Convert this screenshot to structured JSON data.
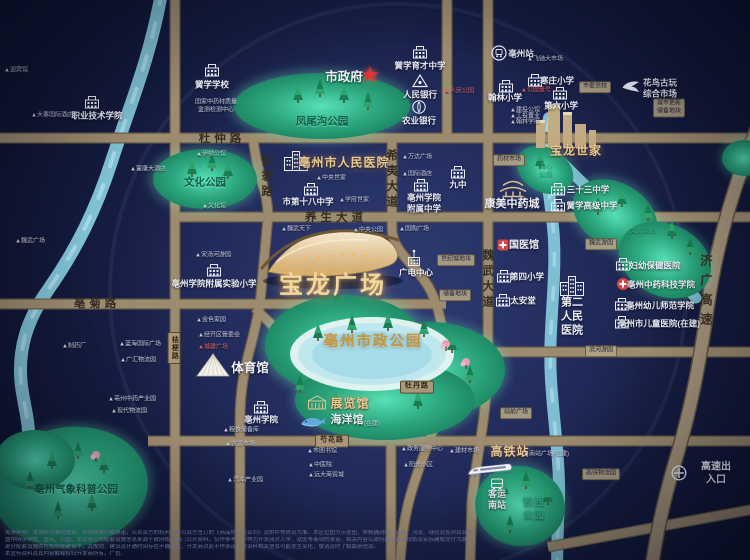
{
  "map": {
    "colors": {
      "background": "#141b3e",
      "road": "#9d8b6f",
      "highway": "#a5947a",
      "river": "#8fd8e9",
      "park": "#2fa980",
      "gold_accent": "#e9c894",
      "red_accent": "#e03434",
      "white_label": "#e9ebf5"
    },
    "labels": [
      {
        "t": "▲迎宾馆",
        "x": 16,
        "y": 71,
        "c": "tiny"
      },
      {
        "t": "▲大寨国际酒店",
        "x": 52,
        "y": 116,
        "c": "tiny"
      },
      {
        "t": "职业技术学院",
        "x": 97,
        "y": 116,
        "c": "w",
        "i": "building",
        "ix": 92,
        "iy": 102,
        "n": "vocational-college"
      },
      {
        "t": "黉学学校",
        "x": 212,
        "y": 85,
        "c": "w",
        "i": "building",
        "ix": 212,
        "iy": 70,
        "n": "hongxue-school"
      },
      {
        "t": "国家中药材质量\n监测检测中心",
        "x": 216,
        "y": 107,
        "c": "tiny"
      },
      {
        "t": "▲富康大酒店",
        "x": 148,
        "y": 170,
        "c": "tiny"
      },
      {
        "t": "凤尾沟公园",
        "x": 322,
        "y": 122,
        "c": "green",
        "n": "fengweigou-park-label"
      },
      {
        "t": "市政府",
        "x": 344,
        "y": 78,
        "c": "wb12",
        "i": "star",
        "ix": 370,
        "iy": 75,
        "n": "city-government"
      },
      {
        "t": "黉学育才中学",
        "x": 420,
        "y": 66,
        "c": "w",
        "i": "building",
        "ix": 420,
        "iy": 52
      },
      {
        "t": "人民银行",
        "x": 420,
        "y": 95,
        "c": "w",
        "i": "bank1",
        "ix": 420,
        "iy": 81
      },
      {
        "t": "农业银行",
        "x": 419,
        "y": 121,
        "c": "w",
        "i": "bank2",
        "ix": 419,
        "iy": 107
      },
      {
        "t": "▲人民公园",
        "x": 459,
        "y": 92,
        "c": "red"
      },
      {
        "t": "亳州站",
        "x": 521,
        "y": 54,
        "c": "w",
        "i": "station",
        "ix": 499,
        "iy": 53,
        "n": "bozhou-railway-station"
      },
      {
        "t": "▲飞驰大市场",
        "x": 545,
        "y": 60,
        "c": "tiny"
      },
      {
        "t": "寒庄小学",
        "x": 557,
        "y": 81,
        "c": "w",
        "i": "building",
        "ix": 535,
        "iy": 80
      },
      {
        "t": "翰林小学",
        "x": 505,
        "y": 98,
        "c": "w",
        "i": "building",
        "ix": 506,
        "iy": 86
      },
      {
        "t": "▲公园壹号",
        "x": 536,
        "y": 91,
        "c": "red"
      },
      {
        "t": "第六小学",
        "x": 561,
        "y": 106,
        "c": "w",
        "i": "building",
        "ix": 560,
        "iy": 93
      },
      {
        "t": "▲建投公馆",
        "x": 525,
        "y": 111,
        "c": "tiny"
      },
      {
        "t": "▲工投置业",
        "x": 525,
        "y": 117,
        "c": "tiny"
      },
      {
        "t": "▲翰林学府",
        "x": 525,
        "y": 123,
        "c": "tiny"
      },
      {
        "t": "市委党校",
        "x": 595,
        "y": 87,
        "c": "box"
      },
      {
        "t": "花鸟古玩\n综合市场",
        "x": 660,
        "y": 88,
        "c": "w",
        "i": "dove",
        "ix": 631,
        "iy": 86,
        "n": "flower-bird-market"
      },
      {
        "t": "城市更新\n储备地块",
        "x": 669,
        "y": 108,
        "c": "box"
      },
      {
        "t": "宝龙世家",
        "x": 576,
        "y": 151,
        "c": "gold",
        "n": "baolong-shijia"
      },
      {
        "t": "杜仲路",
        "x": 222,
        "y": 139,
        "c": "roadH",
        "n": "duzhong-road-label"
      },
      {
        "t": "▲伊顿公馆",
        "x": 211,
        "y": 155,
        "c": "tiny"
      },
      {
        "t": "文化公园",
        "x": 205,
        "y": 183,
        "c": "green",
        "n": "culture-park-label"
      },
      {
        "t": "▲文化馆",
        "x": 214,
        "y": 207,
        "c": "tiny"
      },
      {
        "t": "仙翁路",
        "x": 266,
        "y": 177,
        "c": "roadV",
        "n": "xianweng-road-label"
      },
      {
        "t": "亳州市人民医院",
        "x": 344,
        "y": 163,
        "c": "gold",
        "i": "hospital",
        "ix": 296,
        "iy": 161,
        "n": "people-hospital"
      },
      {
        "t": "▲中央世家",
        "x": 331,
        "y": 179,
        "c": "tiny"
      },
      {
        "t": "市第十八中学",
        "x": 308,
        "y": 202,
        "c": "w",
        "i": "building",
        "ix": 311,
        "iy": 189
      },
      {
        "t": "▲学府世家",
        "x": 354,
        "y": 201,
        "c": "tiny"
      },
      {
        "t": "养生大道",
        "x": 336,
        "y": 218,
        "c": "roadH",
        "n": "yangsheng-avenue-label"
      },
      {
        "t": "希夷大道",
        "x": 391,
        "y": 180,
        "c": "roadV",
        "n": "xiyi-avenue-label"
      },
      {
        "t": "▲万达广场",
        "x": 417,
        "y": 158,
        "c": "tiny"
      },
      {
        "t": "▲国际酒店",
        "x": 417,
        "y": 175,
        "c": "tiny"
      },
      {
        "t": "九中",
        "x": 458,
        "y": 185,
        "c": "w",
        "i": "building",
        "ix": 458,
        "iy": 172
      },
      {
        "t": "亳州学院\n附属中学",
        "x": 424,
        "y": 203,
        "c": "w",
        "i": "building",
        "ix": 421,
        "iy": 185
      },
      {
        "t": "康美中药城",
        "x": 512,
        "y": 205,
        "c": "wb11",
        "i": "pagoda",
        "ix": 513,
        "iy": 187,
        "n": "kangmei-tcm-city"
      },
      {
        "t": "三十三中学",
        "x": 588,
        "y": 190,
        "c": "w",
        "i": "building",
        "ix": 558,
        "iy": 189
      },
      {
        "t": "黉学高级中学",
        "x": 592,
        "y": 206,
        "c": "w",
        "i": "building",
        "ix": 558,
        "iy": 205
      },
      {
        "t": "药材市场",
        "x": 509,
        "y": 160,
        "c": "box"
      },
      {
        "t": "海心\n公园",
        "x": 546,
        "y": 171,
        "c": "greent"
      },
      {
        "t": "文昌公园",
        "x": 643,
        "y": 231,
        "c": "greent"
      },
      {
        "t": "▲魏武天下",
        "x": 296,
        "y": 230,
        "c": "tiny"
      },
      {
        "t": "▲中央公园",
        "x": 368,
        "y": 231,
        "c": "tiny"
      },
      {
        "t": "▲国购广场",
        "x": 414,
        "y": 230,
        "c": "tiny"
      },
      {
        "t": "宝龙广场",
        "x": 333,
        "y": 285,
        "c": "title",
        "n": "project-title"
      },
      {
        "t": "广电中心",
        "x": 416,
        "y": 273,
        "c": "w",
        "i": "tower",
        "ix": 413,
        "iy": 258
      },
      {
        "t": "世纪城地块",
        "x": 456,
        "y": 260,
        "c": "box"
      },
      {
        "t": "储备地块",
        "x": 455,
        "y": 295,
        "c": "box"
      },
      {
        "t": "魏武大道",
        "x": 487,
        "y": 280,
        "c": "roadV",
        "n": "weiwu-avenue-label"
      },
      {
        "t": "国医馆",
        "x": 524,
        "y": 246,
        "c": "wb10",
        "i": "cross",
        "ix": 503,
        "iy": 245
      },
      {
        "t": "第四小学",
        "x": 527,
        "y": 277,
        "c": "w",
        "i": "building",
        "ix": 504,
        "iy": 276
      },
      {
        "t": "太安堂",
        "x": 523,
        "y": 301,
        "c": "w",
        "i": "building",
        "ix": 503,
        "iy": 300
      },
      {
        "t": "第二\n人民\n医院",
        "x": 572,
        "y": 317,
        "c": "wb11",
        "i": "hospital",
        "ix": 572,
        "iy": 286,
        "n": "second-people-hospital"
      },
      {
        "t": "妇幼保健医院",
        "x": 655,
        "y": 266,
        "c": "w",
        "i": "building",
        "ix": 623,
        "iy": 264
      },
      {
        "t": "亳州中药科技学院",
        "x": 661,
        "y": 285,
        "c": "w",
        "i": "crossc",
        "ix": 623,
        "iy": 284
      },
      {
        "t": "亳州幼儿师范学院",
        "x": 660,
        "y": 306,
        "c": "w",
        "i": "building",
        "ix": 622,
        "iy": 304
      },
      {
        "t": "亳州市儿童医院(在建)",
        "x": 659,
        "y": 324,
        "c": "w",
        "i": "building",
        "ix": 622,
        "iy": 322
      },
      {
        "t": "济广高速",
        "x": 704,
        "y": 293,
        "c": "roadVhw",
        "n": "jiguang-expressway-label"
      },
      {
        "t": "魏武游园",
        "x": 601,
        "y": 244,
        "c": "box"
      },
      {
        "t": "滨河游园",
        "x": 601,
        "y": 351,
        "c": "box"
      },
      {
        "t": "亳菊路",
        "x": 97,
        "y": 304,
        "c": "roadH",
        "n": "boju-road-label"
      },
      {
        "t": "▲魏武广场",
        "x": 30,
        "y": 242,
        "c": "tiny"
      },
      {
        "t": "▲制药厂",
        "x": 74,
        "y": 347,
        "c": "tiny"
      },
      {
        "t": "▲蓝海国际广场",
        "x": 140,
        "y": 345,
        "c": "tiny"
      },
      {
        "t": "▲广汇物流园",
        "x": 138,
        "y": 361,
        "c": "tiny"
      },
      {
        "t": "▲亳州中药产业园",
        "x": 132,
        "y": 400,
        "c": "tiny"
      },
      {
        "t": "▲现代物流园",
        "x": 129,
        "y": 412,
        "c": "tiny"
      },
      {
        "t": "桔梗路",
        "x": 174,
        "y": 348,
        "c": "roadBoxV"
      },
      {
        "t": "▲宋汤河游园",
        "x": 213,
        "y": 256,
        "c": "tiny"
      },
      {
        "t": "亳州学院附属实验小学",
        "x": 214,
        "y": 284,
        "c": "w",
        "i": "building",
        "ix": 214,
        "iy": 270
      },
      {
        "t": "▲金色家园",
        "x": 211,
        "y": 321,
        "c": "tiny"
      },
      {
        "t": "▲经开区管委会",
        "x": 219,
        "y": 336,
        "c": "tiny"
      },
      {
        "t": "▲城建广场",
        "x": 213,
        "y": 348,
        "c": "red"
      },
      {
        "t": "体育馆",
        "x": 250,
        "y": 369,
        "c": "wb12",
        "i": "tent",
        "ix": 213,
        "iy": 365,
        "n": "stadium"
      },
      {
        "t": "亳州市政公园",
        "x": 373,
        "y": 342,
        "c": "goldlg",
        "n": "municipal-park-label"
      },
      {
        "t": "牡丹路",
        "x": 417,
        "y": 387,
        "c": "roadBox"
      },
      {
        "t": "展览馆",
        "x": 350,
        "y": 404,
        "c": "gold",
        "i": "expo",
        "ix": 317,
        "iy": 402,
        "n": "exhibition-hall"
      },
      {
        "t": "海洋馆",
        "x": 347,
        "y": 421,
        "c": "wb11",
        "i": "whale",
        "ix": 313,
        "iy": 422,
        "n": "aquarium"
      },
      {
        "t": "(在建)",
        "x": 372,
        "y": 425,
        "c": "tiny"
      },
      {
        "t": "亳州学院",
        "x": 261,
        "y": 420,
        "c": "w",
        "i": "building",
        "ix": 261,
        "iy": 407
      },
      {
        "t": "芍花路",
        "x": 332,
        "y": 441,
        "c": "roadBox"
      },
      {
        "t": "▲市图书馆",
        "x": 322,
        "y": 452,
        "c": "tiny"
      },
      {
        "t": "▲中医院",
        "x": 320,
        "y": 466,
        "c": "tiny"
      },
      {
        "t": "▲远大商贸城",
        "x": 326,
        "y": 476,
        "c": "tiny"
      },
      {
        "t": "▲政务服务中心",
        "x": 422,
        "y": 450,
        "c": "tiny"
      },
      {
        "t": "▲阳光小区",
        "x": 418,
        "y": 466,
        "c": "tiny"
      },
      {
        "t": "▲建材市场",
        "x": 464,
        "y": 452,
        "c": "tiny"
      },
      {
        "t": "▲粮食储备库",
        "x": 241,
        "y": 431,
        "c": "tiny"
      },
      {
        "t": "▲农贸市场",
        "x": 240,
        "y": 445,
        "c": "tiny"
      },
      {
        "t": "▲汽车产业园",
        "x": 245,
        "y": 481,
        "c": "tiny"
      },
      {
        "t": "亳州气象科普公园",
        "x": 76,
        "y": 490,
        "c": "green",
        "n": "meteorology-park-label"
      },
      {
        "t": "站前广场",
        "x": 516,
        "y": 413,
        "c": "box"
      },
      {
        "t": "高铁站",
        "x": 510,
        "y": 452,
        "c": "gold",
        "i": "train",
        "ix": 490,
        "iy": 469,
        "n": "hsr-station"
      },
      {
        "t": "▲南站广场(在建)",
        "x": 546,
        "y": 455,
        "c": "tiny"
      },
      {
        "t": "客运\n南站",
        "x": 497,
        "y": 500,
        "c": "w9",
        "i": "bus",
        "ix": 497,
        "iy": 484,
        "n": "south-bus-station"
      },
      {
        "t": "铁西\n公园",
        "x": 534,
        "y": 510,
        "c": "greenb",
        "n": "tiexi-park-label"
      },
      {
        "t": "高铁物流园",
        "x": 601,
        "y": 474,
        "c": "box"
      },
      {
        "t": "高速出入口",
        "x": 716,
        "y": 474,
        "c": "wb10",
        "i": "inter",
        "ix": 679,
        "iy": 473,
        "n": "expressway-exit"
      }
    ],
    "disclaimer": [
      "免责声明：本资料为要约邀请，不构成要约或承诺，买卖双方的权利义务以双方签订的《商品房买卖合同》及附件等协议为准。本区位图为示意图，非精确测绘，道路、河流、绿化及各项目名称、位置、距离仅供参考。",
      "图中所示学校、医院、公园、车站等公共配套设施信息来源于政府相关部门公开资料，仅作参考，不作为开发商对入学、就医等事项的承诺，相关内容以政府部门最终规划及实际建成交付为准。",
      "部分配套设施尚在规划或建设中，其规划、建设及开通时间存在不确定性，开发商对此不作承诺。本资料相关信息可能发生变化，敬请及时了解最新信息。",
      "本宣传资料及其内容解释权归开发商所有。广告。"
    ]
  }
}
